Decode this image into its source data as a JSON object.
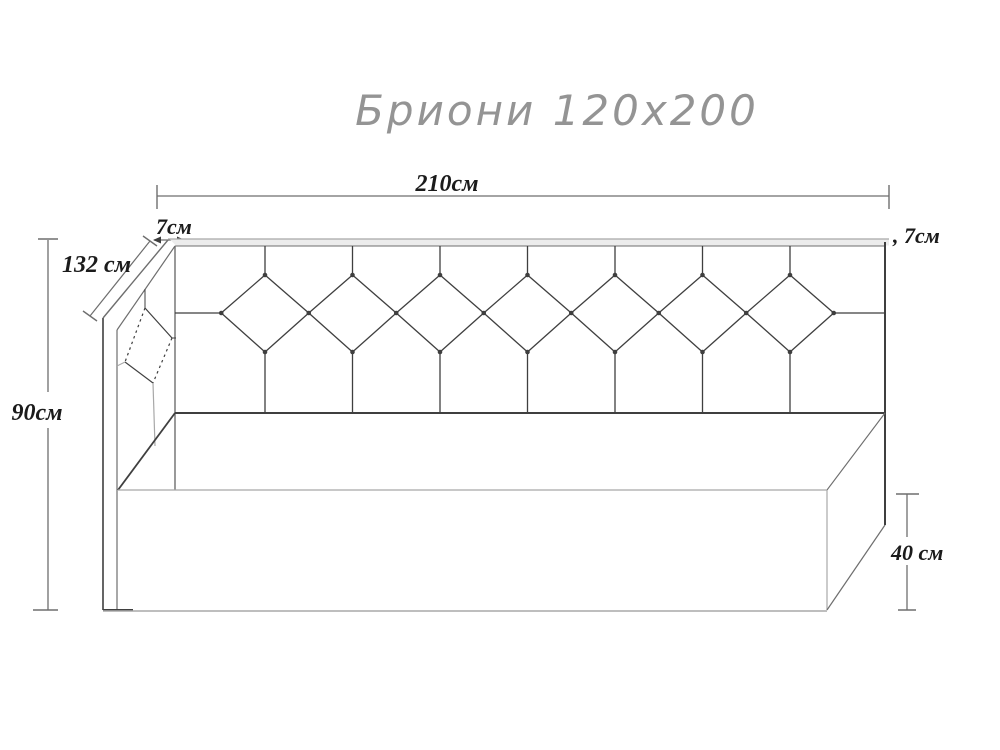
{
  "title": "Бриони 120x200",
  "dimensions": {
    "top_width": {
      "label": "210см",
      "value_cm": 210
    },
    "rail_left": {
      "label": "7см",
      "value_cm": 7
    },
    "rail_right": {
      "label": ", 7см",
      "value_cm": 7
    },
    "side_depth": {
      "label": "132 см",
      "value_cm": 132
    },
    "height": {
      "label": "90см",
      "value_cm": 90
    },
    "base_height": {
      "label": "40 см",
      "value_cm": 40
    }
  },
  "tufting": {
    "headboard_diamond_count": 7,
    "side_panel_diamond_count": 1
  },
  "colors": {
    "background": "#ffffff",
    "line_dark": "#3f3f3f",
    "line_mid": "#6e6e6e",
    "line_light": "#a8a8a8",
    "label_text": "#1b1b1b",
    "title_text": "#949494"
  }
}
